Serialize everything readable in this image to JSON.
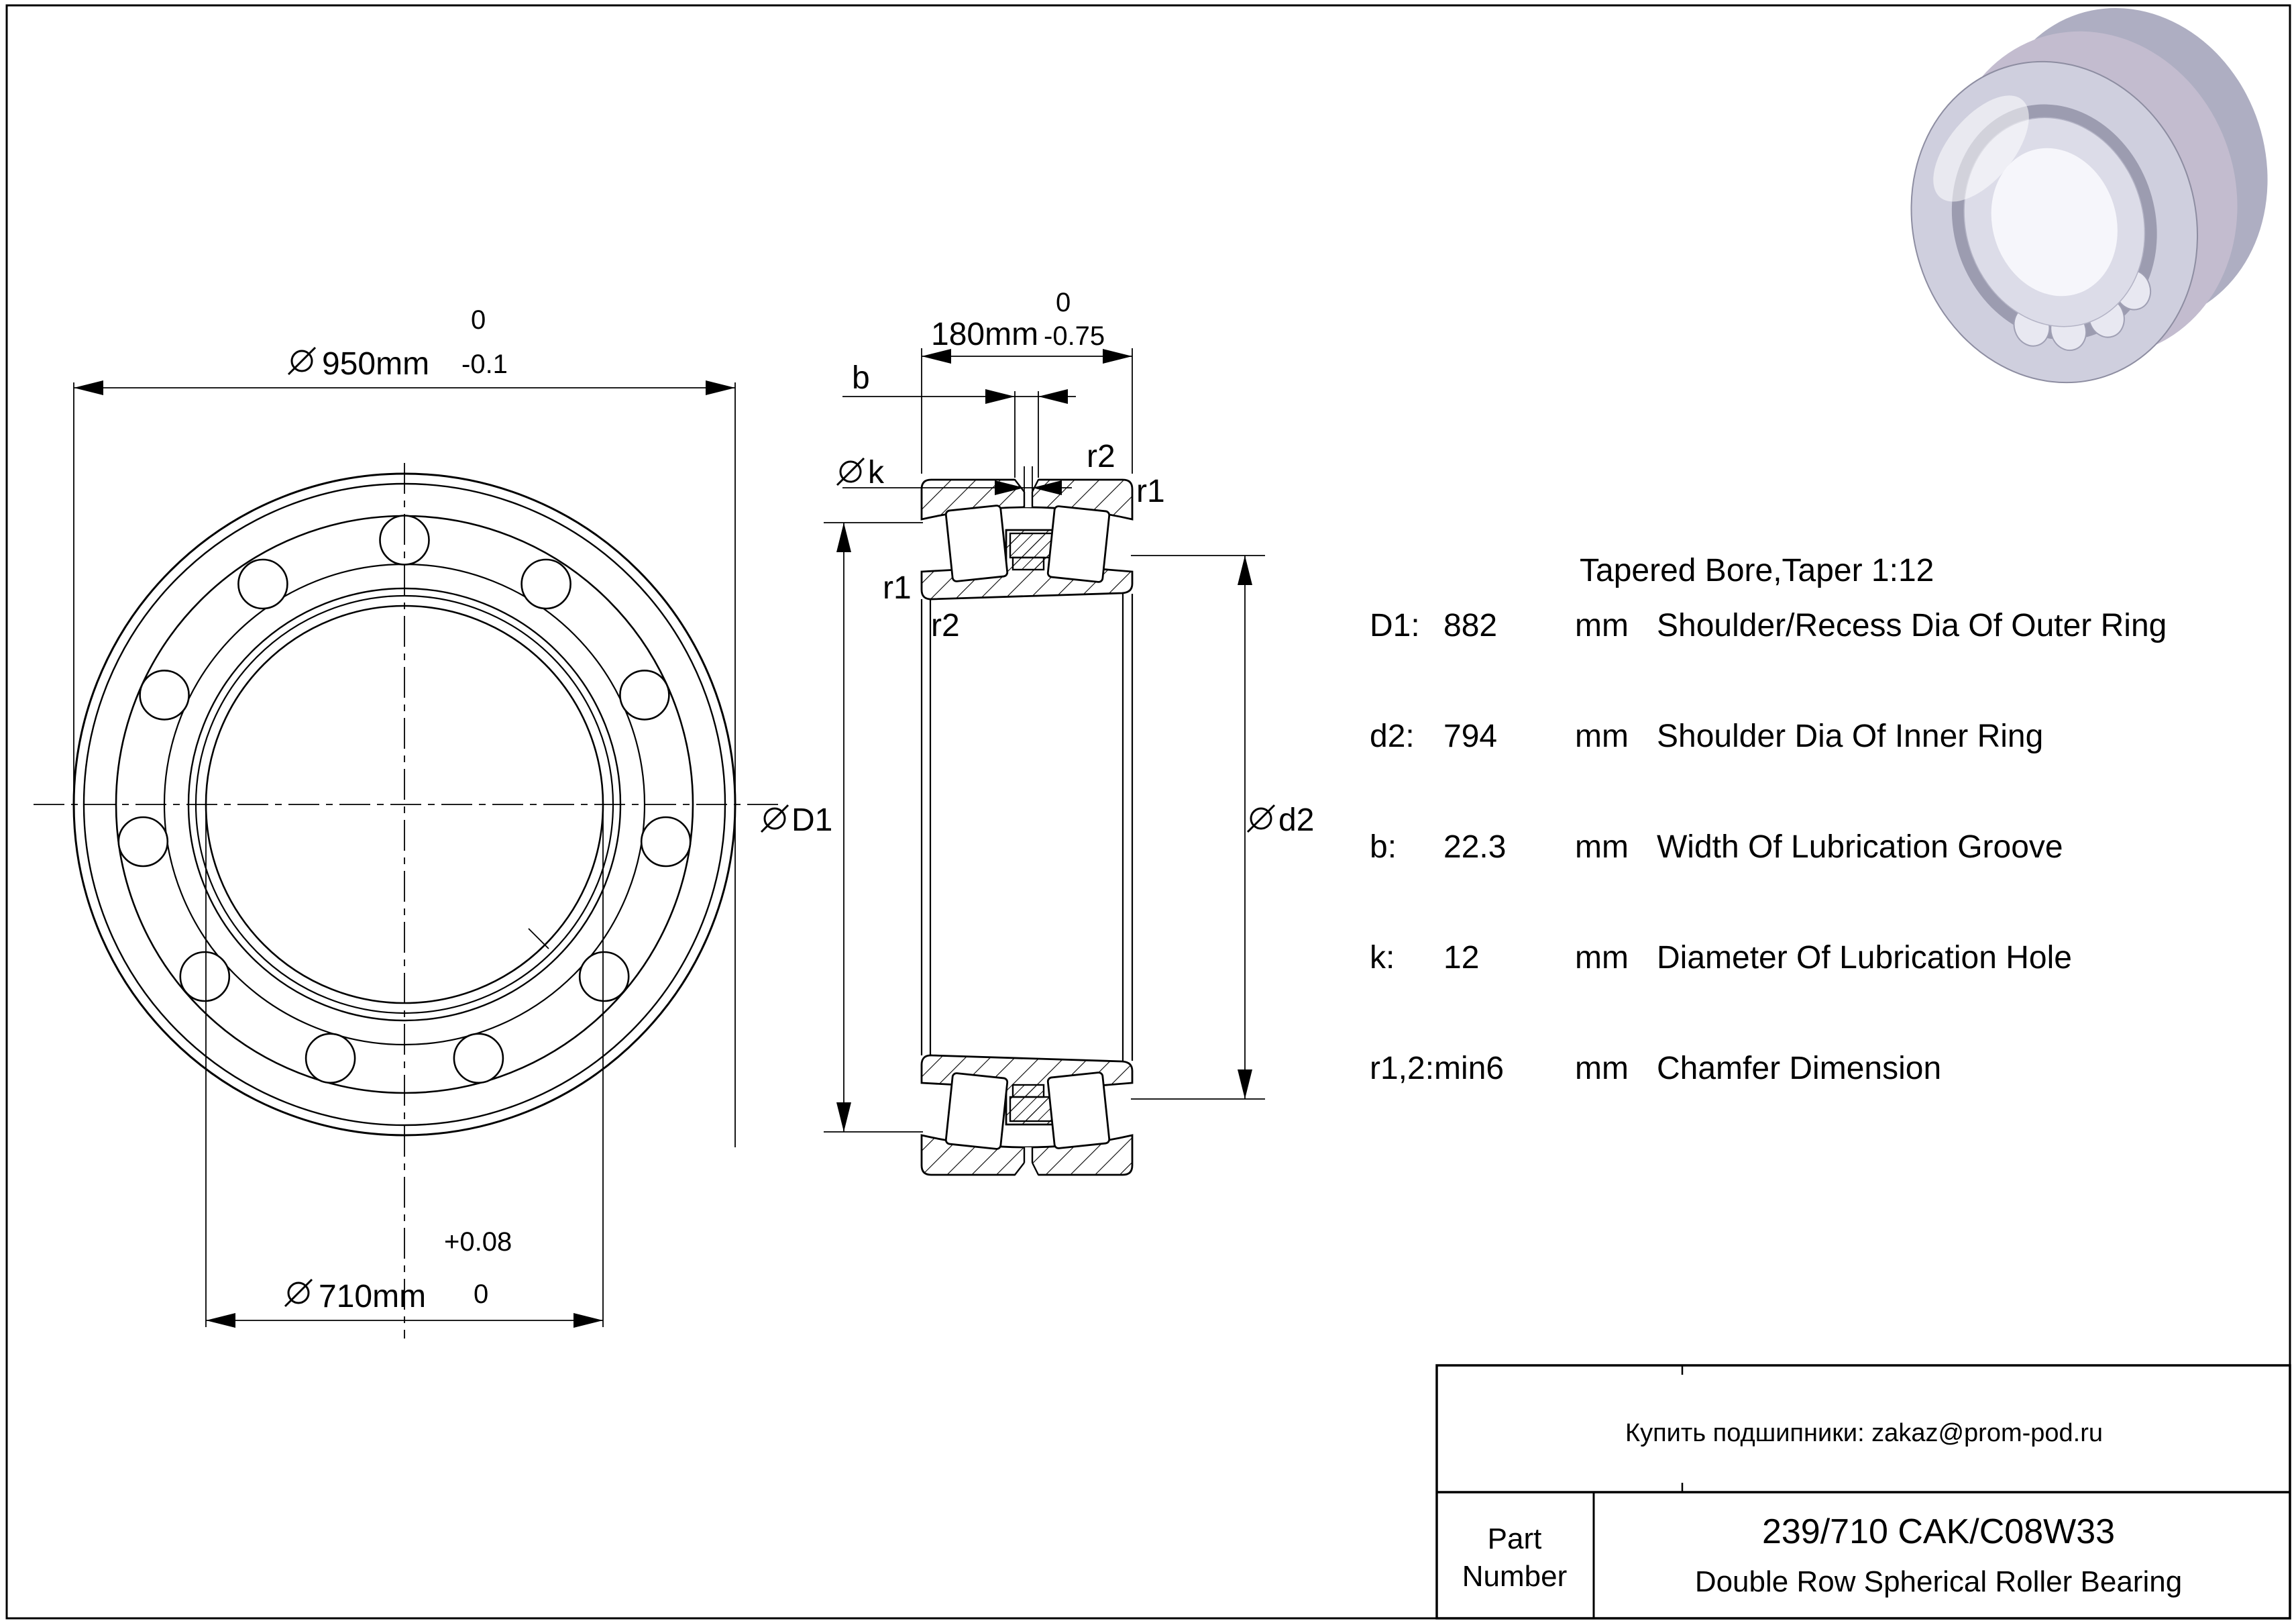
{
  "front_view": {
    "dim_od": {
      "dia_symbol": "⌀",
      "value": "950mm",
      "tol_upper": "0",
      "tol_lower": "-0.1"
    },
    "dim_bore": {
      "dia_symbol": "⌀",
      "value": "710mm",
      "tol_upper": "+0.08",
      "tol_lower": "0"
    }
  },
  "section_view": {
    "dim_width": {
      "value": "180mm",
      "tol_upper": "0",
      "tol_lower": "-0.75"
    },
    "labels": {
      "b": "b",
      "k": "k",
      "r1": "r1",
      "r2": "r2",
      "D1": "D1",
      "d2": "d2"
    }
  },
  "specs": {
    "header": "Tapered Bore,Taper 1:12",
    "rows": [
      {
        "param": "D1:",
        "value": "882",
        "unit": "mm",
        "desc": "Shoulder/Recess Dia Of Outer Ring"
      },
      {
        "param": "d2:",
        "value": "794",
        "unit": "mm",
        "desc": "Shoulder Dia Of Inner Ring"
      },
      {
        "param": "b:",
        "value": "22.3",
        "unit": "mm",
        "desc": "Width Of Lubrication Groove"
      },
      {
        "param": "k:",
        "value": "12",
        "unit": "mm",
        "desc": "Diameter Of Lubrication Hole"
      },
      {
        "param": "r1,2:min6",
        "value": "",
        "unit": "mm",
        "desc": "Chamfer Dimension"
      }
    ]
  },
  "title_block": {
    "contact": "Купить подшипники: zakaz@prom-pod.ru",
    "part_label_line1": "Part",
    "part_label_line2": "Number",
    "part_number": "239/710 CAK/C08W33",
    "part_description": "Double Row Spherical Roller Bearing"
  }
}
